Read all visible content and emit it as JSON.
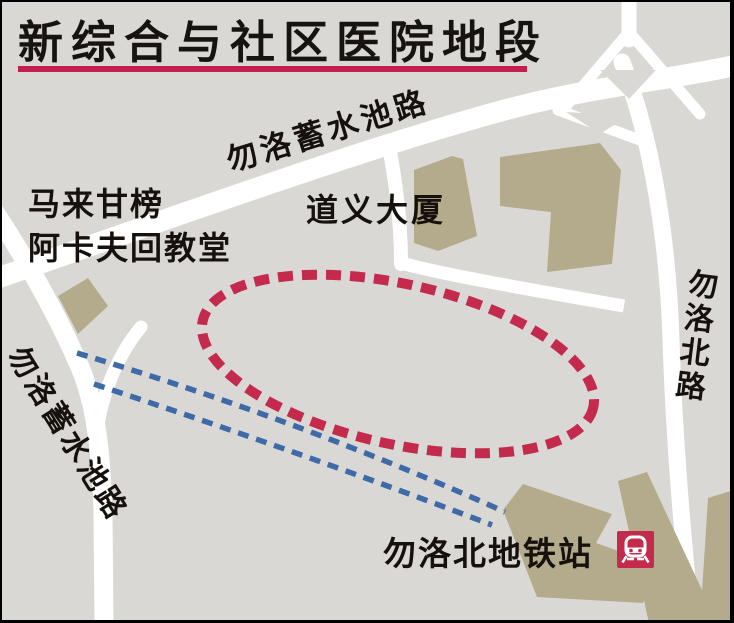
{
  "title": {
    "text": "新综合与社区医院地段"
  },
  "map": {
    "road_labels": {
      "bedok_reservoir_top": "勿洛蓄水池路",
      "bedok_reservoir_left": "勿洛蓄水池路",
      "bedok_north": "勿洛北路"
    },
    "place_labels": {
      "mosque_line1": "马来甘榜",
      "mosque_line2": "阿卡夫回教堂",
      "towers": "道义大厦",
      "mrt_station": "勿洛北地铁站"
    },
    "icons": {
      "mrt": "train-icon"
    },
    "colors": {
      "background": "#dad8d5",
      "road": "#ffffff",
      "building": "#b3ab8c",
      "site_outline_red": "#c32a4c",
      "mrt_line_blue": "#3f6aa8",
      "title_underline": "#c2204a",
      "text": "#16110d"
    }
  }
}
